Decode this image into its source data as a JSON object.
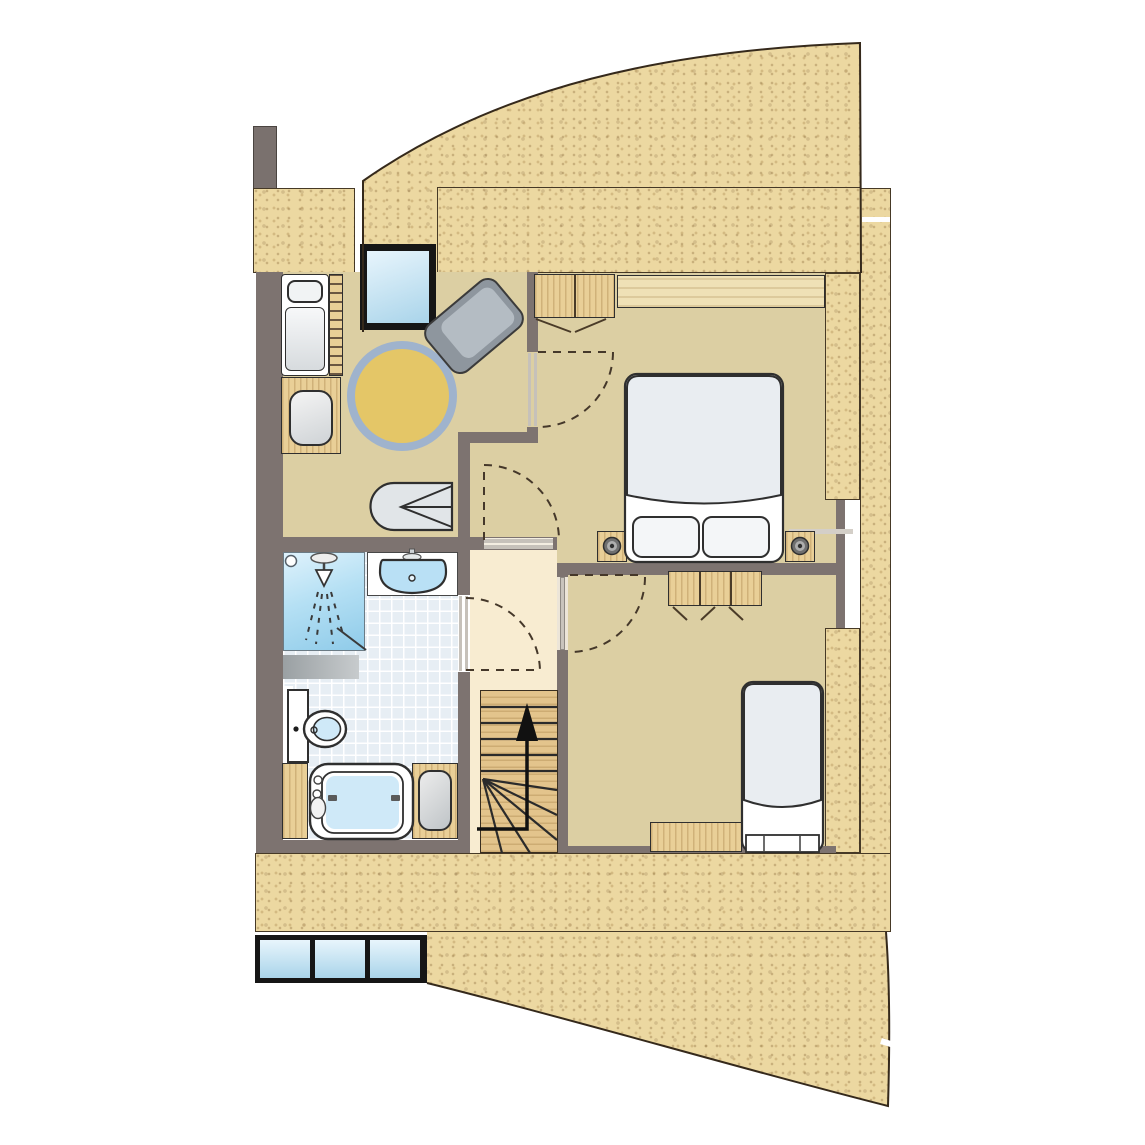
{
  "title": "Apartment upper-floor architectural plan",
  "theme": {
    "colors": {
      "wall": "#7d7370",
      "sand": "#ecd8a1",
      "floor": "#dccfa3",
      "hall": "#f8ecd1",
      "wood": "#e9cf97",
      "woodlight": "#efe1b6",
      "tile": "#e7eef4",
      "rug_yellow": "#e4c667",
      "rug_ring": "#9fb3cd",
      "fixture_blue": "#b9e0f5",
      "glass_a": "#e8f5fc",
      "glass_b": "#a9d4ea",
      "chair_gray": "#8e969e",
      "frame_black": "#161616",
      "jamb": "#c6c1ba",
      "chimney": "#7a716e",
      "outline": "#32291d"
    }
  },
  "exterior": {
    "texture": "speckled-sand",
    "curved_roof_sail_top": true,
    "curved_roof_sail_bottom": true,
    "chimney_stub": true,
    "section_notches": 2
  },
  "windows": {
    "bottom_strip_panes": 3,
    "roof_window_top": 1
  },
  "rooms": [
    {
      "id": "studio",
      "furniture": [
        "daybed-with-pillow",
        "wall-rack-ladder",
        "wood-bench",
        "pouf",
        "round-yellow-rug",
        "gray-armchair",
        "lounge-chair"
      ]
    },
    {
      "id": "master-bedroom",
      "furniture": [
        "double-bed",
        "pillow-left",
        "pillow-right",
        "nightstand-lamp-left",
        "nightstand-lamp-right",
        "wall-closet-strip",
        "two-door-wardrobe"
      ],
      "doors": [
        "door-to-studio",
        "door-to-hall-nook"
      ]
    },
    {
      "id": "hall",
      "features": [
        "staircase",
        "landing"
      ],
      "doors": [
        "door-to-master-nook",
        "door-to-bathroom",
        "door-to-second-bedroom"
      ]
    },
    {
      "id": "bathroom",
      "fixtures": [
        "shower-cabin",
        "bath-mat",
        "washbasin-counter",
        "bidet",
        "bathtub",
        "vanity-cabinet-left",
        "stool-cabinet-right"
      ],
      "floor": "blue-tiles"
    },
    {
      "id": "second-bedroom",
      "furniture": [
        "three-door-wardrobe",
        "single-bed",
        "desk"
      ]
    }
  ],
  "stairs": {
    "direction": "up",
    "arrow": true,
    "straight_treads": 5,
    "winder_treads": 5
  }
}
